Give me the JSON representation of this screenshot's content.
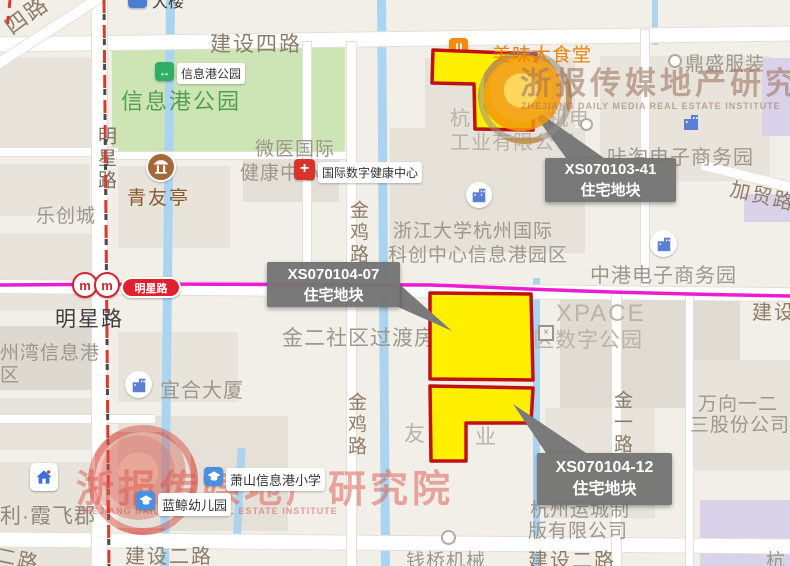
{
  "watermark": {
    "cn": "浙报传媒地产研究院",
    "en": "ZHEJIANG DAILY MEDIA REAL ESTATE INSTITUTE"
  },
  "parcels": [
    {
      "id": "XS070103-41",
      "type": "住宅地块"
    },
    {
      "id": "XS070104-07",
      "type": "住宅地块"
    },
    {
      "id": "XS070104-12",
      "type": "住宅地块"
    }
  ],
  "colors": {
    "parcel_fill": "#ffef00",
    "parcel_border": "#c01010",
    "metro_line": "#ec1cd3",
    "boundary": "#d93a2f",
    "label_box": "#757575",
    "park_green": "#cde5b5",
    "water": "#aad4f0"
  },
  "roads": {
    "jianshe4": "建设四路",
    "jianshe2_a": "建设二路",
    "jianshe2_b": "建设二路",
    "jianshe_right": "建设",
    "erlu_frag": "二路",
    "silu_frag": "四路",
    "jiamao": "加贸路",
    "jinji_a": "金鸡路",
    "jinji_b": "金鸡路",
    "jinyi": "金一路",
    "mingxing_v": "明星路",
    "mingxing_h": "明星路"
  },
  "metro": {
    "station": "明星路",
    "logo": "m"
  },
  "icons": {
    "hospital_cross": "+",
    "park_arrows": "↔",
    "gate_x": "×"
  },
  "pois": {
    "top_clipped": "大楼",
    "canteen": "美味大食堂",
    "dingsheng": "鼎盛服装",
    "katao": "咔淘电子商务园",
    "hangjd_l1a": "杭",
    "hangjd_l1b": "机电",
    "hangjd_l2": "工业有限公司",
    "zju_l1": "浙江大学杭州国际",
    "zju_l2": "科创中心信息港园区",
    "zhonggang": "中港电子商务园",
    "weiyi_l1": "微医国际",
    "weiyi_l2": "健康中心",
    "health_center": "国际数字健康中心",
    "park_big": "信息港公园",
    "park_label": "信息港公园",
    "qingyouting": "青友亭",
    "lechuangcheng": "乐创城",
    "jiner": "金二社区过渡房",
    "xpace_l1": "XPACE",
    "xpace_l2": "区数字公园",
    "wanxiang_l1": "万向一二",
    "wanxiang_l2": "三股份公司",
    "yuncheng_l1": "杭州运城制",
    "yuncheng_l2": "版有限公司",
    "you": "友",
    "ye": "业",
    "qianqiao": "钱桥机械",
    "yihe": "宜合大厦",
    "zhouwan_l1": "州湾信息港",
    "zhouwan_l2": "区",
    "xiaoxue": "萧山信息港小学",
    "lanjing": "蓝鲸幼儿园",
    "xiafeijun": "利·霞飞郡",
    "hang_br": "杭"
  }
}
